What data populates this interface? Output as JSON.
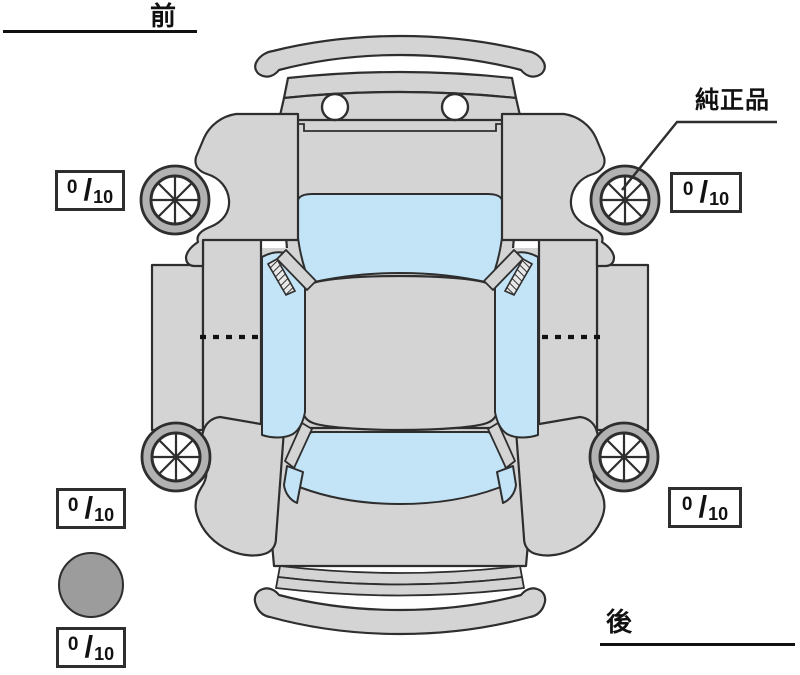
{
  "colors": {
    "bg": "#ffffff",
    "body": "#d4d4d4",
    "glass": "#c2e4f6",
    "tire": "#b2b2b2",
    "spare": "#9c9c9c",
    "line": "#2e2e2e",
    "text": "#111111"
  },
  "labels": {
    "front": "前",
    "rear": "後",
    "genuine_part": "純正品"
  },
  "tread": {
    "slash": "/",
    "front_left": {
      "num": "0",
      "den": "10"
    },
    "front_right": {
      "num": "0",
      "den": "10"
    },
    "rear_left": {
      "num": "0",
      "den": "10"
    },
    "rear_right": {
      "num": "0",
      "den": "10"
    },
    "spare": {
      "num": "0",
      "den": "10"
    }
  }
}
